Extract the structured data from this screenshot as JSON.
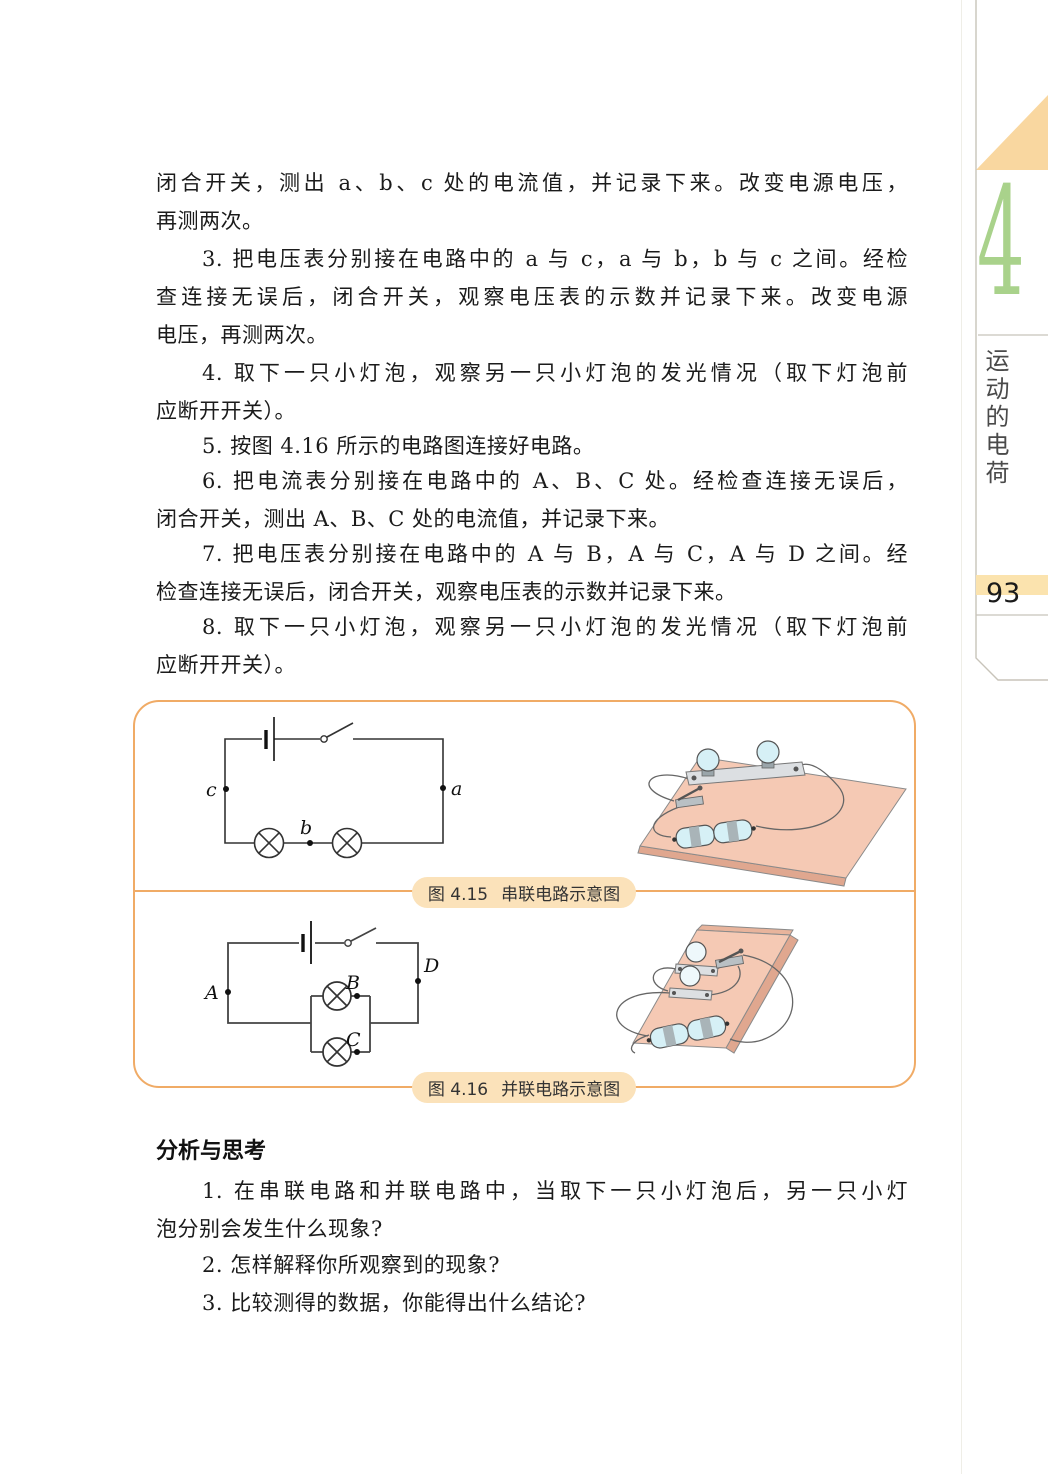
{
  "page": {
    "number": "93",
    "chapter_number": "4",
    "chapter_title_vertical": "运动的电荷"
  },
  "body": {
    "lines": [
      "闭合开关，测出 a、b、c 处的电流值，并记录下来。改变电源电压，",
      "再测两次。",
      "3. 把电压表分别接在电路中的 a 与 c，a 与 b，b 与 c 之间。经检",
      "查连接无误后，闭合开关，观察电压表的示数并记录下来。改变电源",
      "电压，再测两次。",
      "4. 取下一只小灯泡，观察另一只小灯泡的发光情况（取下灯泡前",
      "应断开开关）。",
      "5. 按图 4.16 所示的电路图连接好电路。",
      "6. 把电流表分别接在电路中的 A、B、C 处。经检查连接无误后，",
      "闭合开关，测出 A、B、C 处的电流值，并记录下来。",
      "7. 把电压表分别接在电路中的 A 与 B，A 与 C，A 与 D 之间。经",
      "检查连接无误后，闭合开关，观察电压表的示数并记录下来。",
      "8. 取下一只小灯泡，观察另一只小灯泡的发光情况（取下灯泡前",
      "应断开开关）。"
    ]
  },
  "figure_panel": {
    "figures": [
      {
        "caption_label": "图 4.15",
        "caption_title": "串联电路示意图",
        "diagram_labels": {
          "left": "c",
          "right": "a",
          "bottom": "b"
        }
      },
      {
        "caption_label": "图 4.16",
        "caption_title": "并联电路示意图",
        "diagram_labels": {
          "left": "A",
          "right": "D",
          "branch_top": "B",
          "branch_bottom": "C"
        }
      }
    ]
  },
  "analysis": {
    "heading": "分析与思考",
    "lines": [
      "1. 在串联电路和并联电路中，当取下一只小灯泡后，另一只小灯",
      "泡分别会发生什么现象?",
      "2. 怎样解释你所观察到的现象?",
      "3. 比较测得的数据，你能得出什么结论?"
    ]
  },
  "colors": {
    "accent_orange": "#f0ab66",
    "badge_fill": "#fbe2ba",
    "chapter_green": "#a9d28b",
    "page_tab_band": "#fbe3ae",
    "corner_triangle": "#f9d7a0",
    "board_pink": "#f5c9b4",
    "bulb_cyan": "#d6f0f6"
  }
}
